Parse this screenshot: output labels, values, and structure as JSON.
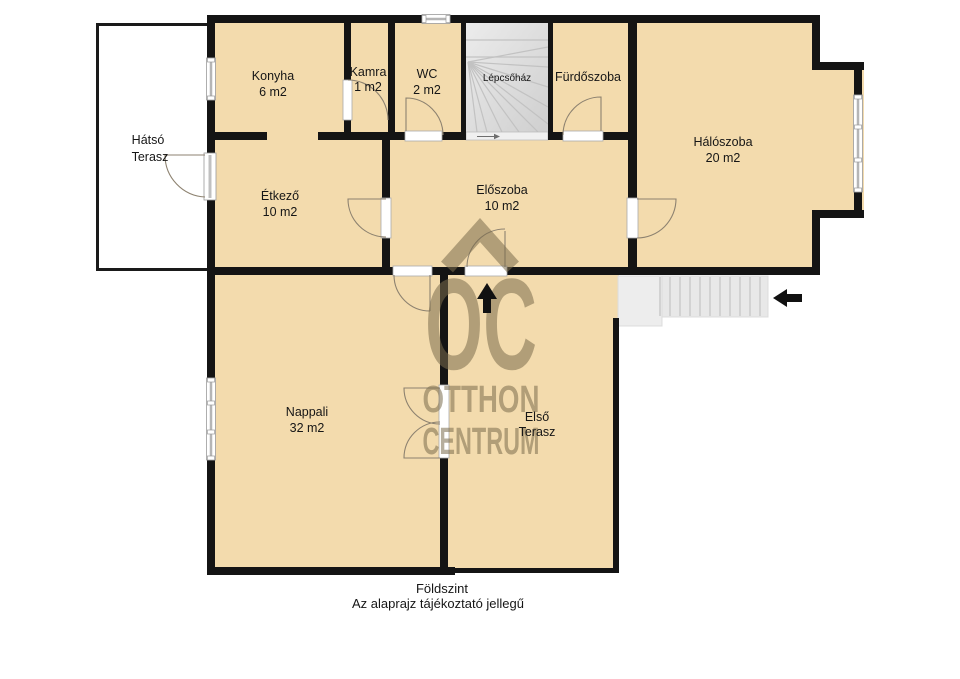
{
  "rooms": {
    "konyha": {
      "name": "Konyha",
      "area": "6 m2"
    },
    "kamra": {
      "name": "Kamra",
      "area": "1 m2"
    },
    "wc": {
      "name": "WC",
      "area": "2 m2"
    },
    "lepcsohaz": {
      "name": "Lépcsőház"
    },
    "furdoszoba": {
      "name": "Fürdőszoba"
    },
    "haloszoba": {
      "name": "Hálószoba",
      "area": "20 m2"
    },
    "etkezo": {
      "name": "Étkező",
      "area": "10 m2"
    },
    "eloszoba": {
      "name": "Előszoba",
      "area": "10 m2"
    },
    "nappali": {
      "name": "Nappali",
      "area": "32 m2"
    },
    "hatso_terasz": {
      "line1": "Hátsó",
      "line2": "Terasz"
    },
    "elso_terasz": {
      "line1": "Első",
      "line2": "Terasz"
    }
  },
  "watermark": {
    "logo": "OC",
    "line1": "OTTHON",
    "line2": "CENTRUM"
  },
  "footer": {
    "line1": "Földszint",
    "line2": "Az alaprajz tájékoztató jellegű"
  },
  "colors": {
    "floor": "#f3dbad",
    "wall": "#141414",
    "terrace_fill": "#ffffff",
    "stairs": "#e3e3e3",
    "watermark": "#7a6b4c",
    "arrow": "#111111"
  }
}
